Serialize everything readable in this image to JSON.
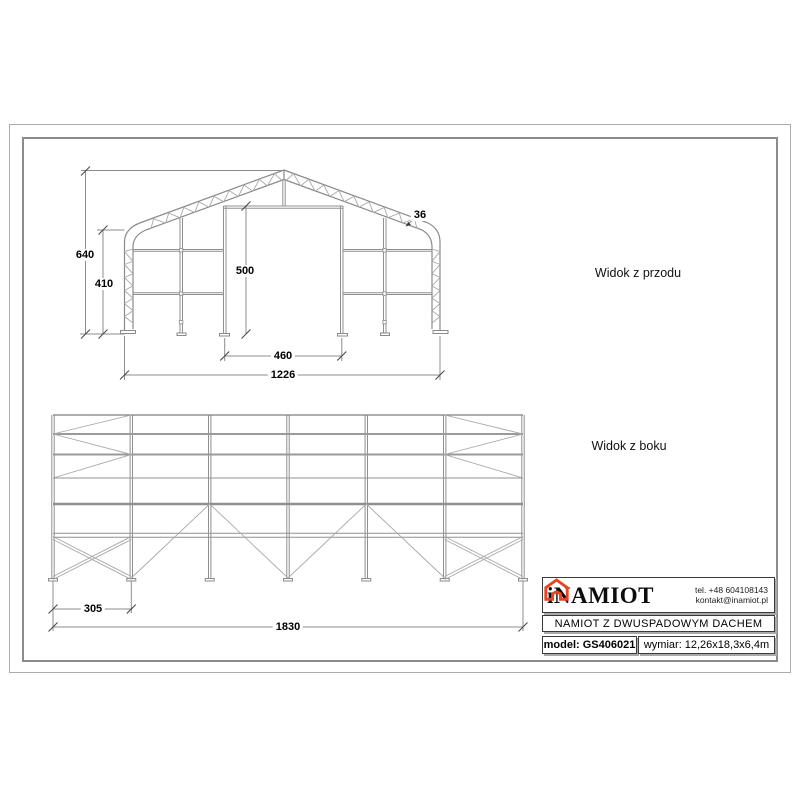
{
  "front_view": {
    "title": "Widok z przodu",
    "dims": {
      "total_height": "640",
      "wall_height": "410",
      "door_height": "500",
      "door_width": "460",
      "total_width": "1226",
      "truss_depth": "36"
    }
  },
  "side_view": {
    "title": "Widok z boku",
    "dims": {
      "bay_width": "305",
      "total_length": "1830"
    }
  },
  "title_block": {
    "brand": "iNAMIOT",
    "phone": "tel. +48 604108143",
    "email": "kontakt@inamiot.pl",
    "product_name": "NAMIOT Z DWUSPADOWYM DACHEM",
    "model_label": "model:",
    "model_value": "GS406021",
    "size_label": "wymiar:",
    "size_value": "12,26x18,3x6,4m"
  },
  "colors": {
    "accent": "#e8441f",
    "line_gray": "#909090"
  }
}
